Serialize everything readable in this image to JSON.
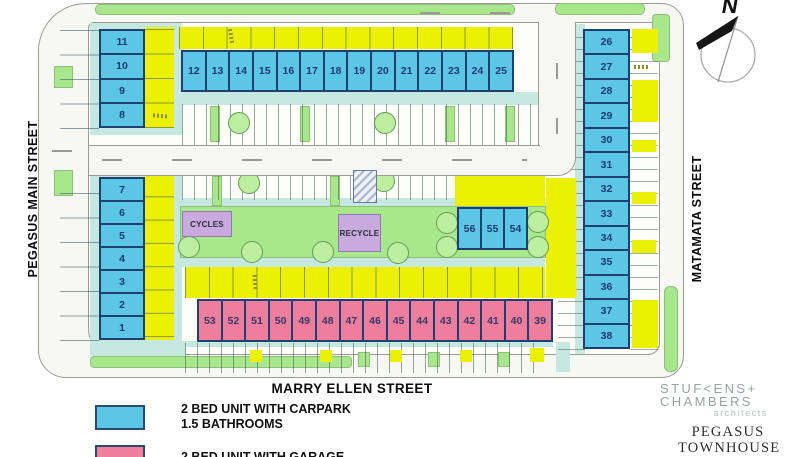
{
  "plan": {
    "streets": {
      "left": "PEGASUS MAIN STREET",
      "right": "MATAMATA STREET",
      "bottom": "MARRY ELLEN STREET"
    },
    "compass_label": "N",
    "units": {
      "left_top": [
        "11",
        "10",
        "9",
        "8"
      ],
      "left_bottom": [
        "7",
        "6",
        "5",
        "4",
        "3",
        "2",
        "1"
      ],
      "top_row": [
        "12",
        "13",
        "14",
        "15",
        "16",
        "17",
        "18",
        "19",
        "20",
        "21",
        "22",
        "23",
        "24",
        "25"
      ],
      "right_col": [
        "26",
        "27",
        "28",
        "29",
        "30",
        "31",
        "32",
        "33",
        "34",
        "35",
        "36",
        "37",
        "38"
      ],
      "center_row": [
        "56",
        "55",
        "54"
      ],
      "garage_row": [
        "53",
        "52",
        "51",
        "50",
        "49",
        "48",
        "47",
        "46",
        "45",
        "44",
        "43",
        "42",
        "41",
        "40",
        "39"
      ]
    },
    "facilities": {
      "cycles": "CYCLES",
      "recycle": "RECYCLE"
    },
    "legend": {
      "items": [
        {
          "swatch_color": "#5cc6e6",
          "lines": [
            "2 BED UNIT WITH CARPARK",
            "1.5 BATHROOMS"
          ]
        },
        {
          "swatch_color": "#ee7e9b",
          "lines": [
            "2 BED UNIT WITH GARAGE"
          ]
        }
      ]
    },
    "branding": {
      "firm_line1": "STUF<ENS+",
      "firm_line2": "CHAMBERS",
      "firm_line3": "architects",
      "project_line1": "PEGASUS",
      "project_line2": "TOWNHOUSE"
    },
    "colors": {
      "carpark_unit": "#5cc6e6",
      "garage_unit": "#ee7e9b",
      "unit_border": "#1d4070",
      "grass": "#a8e78c",
      "path_teal": "#c5e9e1",
      "yellow": "#ecf104",
      "facility_purple": "#c9a9de"
    }
  }
}
